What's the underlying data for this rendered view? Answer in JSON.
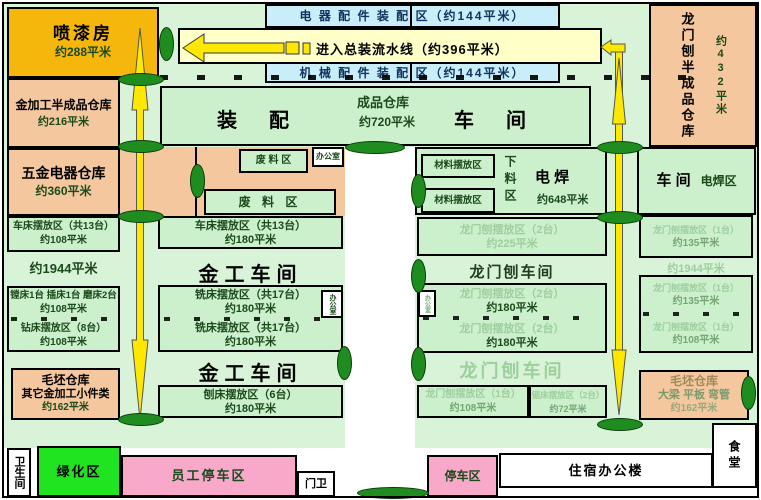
{
  "colors": {
    "green-bg": "#d8f3d8",
    "green-box": "#ccefcc",
    "salmon": "#f4c79e",
    "orange": "#f6b70d",
    "cyan": "#c9eef9",
    "pale": "#ffffc8",
    "yellow": "#ffe800",
    "pink": "#f8a9ca",
    "bright-green": "#21e421",
    "tree": "#1e8c1e",
    "dk": "#1b4a1b",
    "washed": "#9dcf9d",
    "washed2": "#74a874"
  },
  "left": {
    "paint": {
      "title": "喷漆房",
      "area": "约288平米"
    },
    "metal_semi": {
      "title": "金加工半成品仓库",
      "area": "约216平米"
    },
    "hardware": {
      "title": "五金电器仓库",
      "area": "约360平米"
    },
    "lathe": {
      "title": "车床摆放区（共13台）",
      "area": "约108平米"
    },
    "total": "约1944平米",
    "boring": {
      "title": "镗床1台 插床1台 磨床2台",
      "area": "约108平米"
    },
    "drill": {
      "title": "钻床摆放区（8台）",
      "area": "约108平米"
    },
    "blank": {
      "title": "毛坯仓库",
      "sub": "其它金加工小件类",
      "area": "约162平米"
    }
  },
  "top": {
    "strip_elec": "电 器 配 件 装 配 区（约144平米）",
    "flow": "进入总装流水线（约396平米）",
    "strip_mech": "机 械 配 件 装 配 区（约144平米）",
    "assembly": {
      "t1": "装　配",
      "mid1": "成品仓库",
      "mid2": "约720平米",
      "t2": "车　间"
    },
    "lm_semi": {
      "title": "龙门刨半成品仓库",
      "area": "约432平米"
    }
  },
  "mid": {
    "scrap1": "废 料 区",
    "scrap2": "废  料  区",
    "office": "办公室",
    "lathe": {
      "title": "车床摆放区（共13台）",
      "area": "约180平米"
    },
    "shop": "金工车间",
    "mill": {
      "title": "铣床摆放区（共17台）",
      "area": "约180平米"
    },
    "planer": {
      "title": "刨床摆放区（6台）",
      "area": "约180平米"
    }
  },
  "weld": {
    "material": "材料摆放区",
    "xialiao": "下料区",
    "t1": "电 焊",
    "area": "约648平米",
    "t2": "车 间",
    "t3": "电焊区"
  },
  "lm": {
    "p225": {
      "title": "龙门刨摆放区（2台）",
      "area": "约225平米"
    },
    "shop": "龙门刨车间",
    "p180": {
      "title": "龙门刨摆放区（2台）",
      "area": "约180平米"
    },
    "p108": {
      "title": "龙门刨摆放区（1台）",
      "area": "约108平米"
    },
    "saw": {
      "title": "锯床摆放区（2台）",
      "area": "约72平米"
    }
  },
  "right": {
    "p135": {
      "title": "龙门刨摆放区（1台）",
      "area": "约135平米"
    },
    "total": "约1944平米",
    "p108": {
      "title": "龙门刨摆放区（1台）",
      "area": "约108平米"
    },
    "blank": {
      "title": "毛坯仓库",
      "sub": "大梁  平板  弯管",
      "area": "约162平米"
    }
  },
  "bottom": {
    "toilet": "卫生间",
    "green": "绿化区",
    "staff_parking": "员工停车区",
    "gate": "门卫",
    "parking": "停车区",
    "dorm": "住宿办公楼",
    "canteen": "食堂"
  }
}
